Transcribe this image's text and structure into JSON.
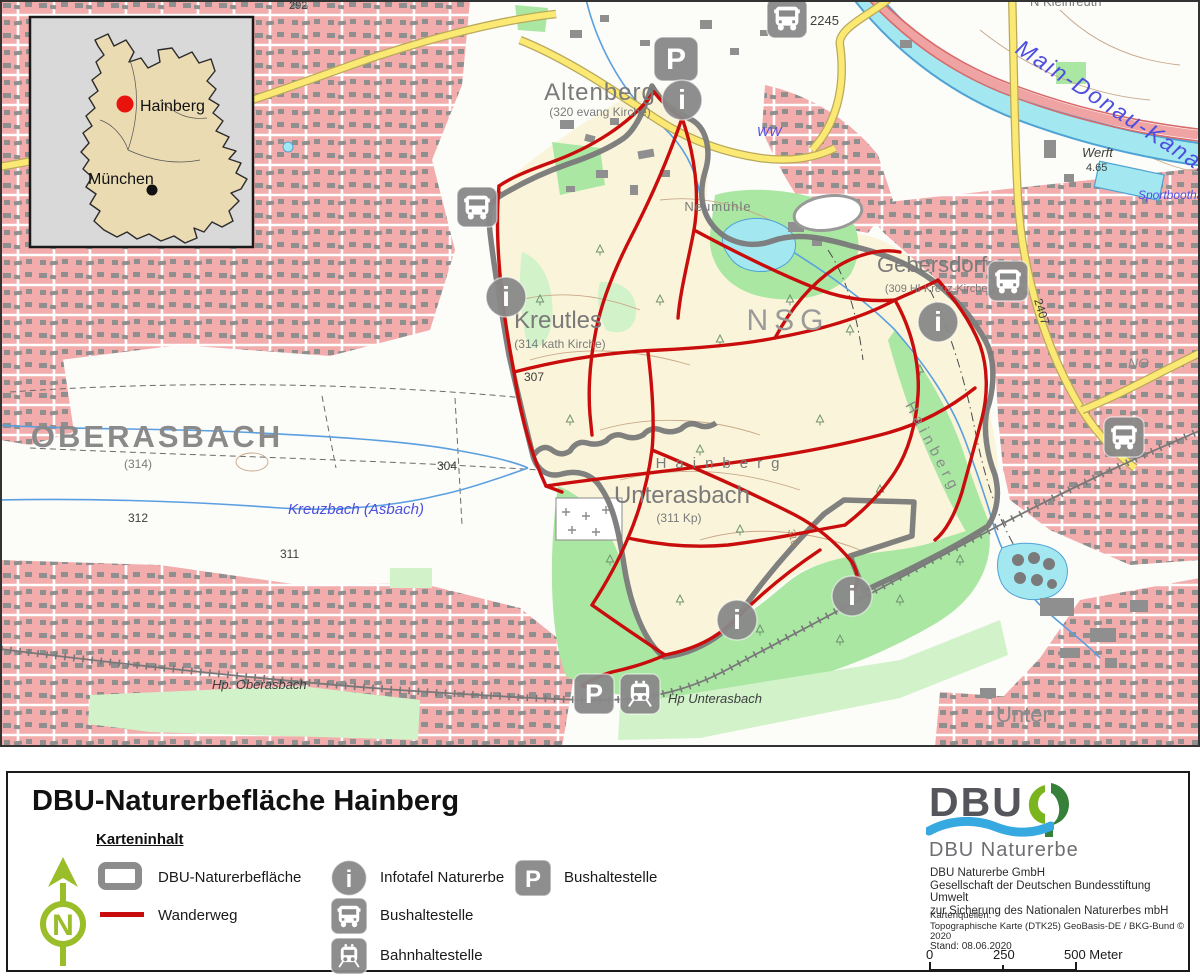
{
  "colors": {
    "trail_red": "#C90D0D",
    "boundary_gray": "#7B7B7B",
    "icon_gray": "#898989",
    "urban_pink": "#F2ACAC",
    "nature_cream": "#FAF5DA",
    "forest_green": "#A9E7A2",
    "forest_light": "#D2F2CA",
    "water_cyan": "#A3E8F0",
    "road_yellow": "#FBE974",
    "north_arrow_green": "#9ABD2A",
    "logo_green_light": "#7AB51D",
    "logo_green_dark": "#37803A",
    "logo_wave_blue": "#36A9E1",
    "marker_red": "#E8130C",
    "inset_land": "#EADBB2",
    "inset_bg": "#D9D9D9"
  },
  "inset": {
    "labels": {
      "hainberg": "Hainberg",
      "muenchen": "München"
    }
  },
  "map": {
    "icon_glyphs": {
      "info": "i",
      "parking": "P"
    },
    "labels": {
      "region_292": "292",
      "altenberg": "Altenberg",
      "altenberg_sub": "(320 evang Kirche)",
      "neumuehle": "Neumühle",
      "kleinreuth": "N Kleinreuth",
      "kreutles": "Kreutles",
      "kreutles_sub": "(314 kath Kirche)",
      "nsg": "NSG",
      "oberasbach": "OBERASBACH",
      "oberasbach_sub": "(314)",
      "gebersdorf": "Gebersdorf",
      "gebersdorf_sub": "(309 Hl-Kreuz-Kirche)",
      "hainberg_flur": "Hainberg",
      "hainberg_hill": "Hainberg",
      "unterasbach": "Unterasbach",
      "unterasbach_sub": "(311 Kp)",
      "unter": "Unter",
      "main_donau_kanal": "Main-Donau-Kanal",
      "kreuzbach": "Kreuzbach  (Asbach)",
      "werft": "Werft",
      "werft_elev": "4.65",
      "sportboothafen": "Sportboothafen",
      "ww": "WW",
      "hp_oberasbach": "Hp. Oberasbach",
      "hp_unterasbach": "Hp Unterasbach",
      "elev_304": "304",
      "elev_307": "307",
      "elev_310": "310",
      "elev_311": "311",
      "elev_312": "312",
      "road_2245": "2245",
      "road_2407": "2407",
      "no_frag": "NO"
    }
  },
  "legend": {
    "title": "DBU-Naturerbefläche Hainberg",
    "section_title": "Karteninhalt",
    "north_letter": "N",
    "items": [
      {
        "label": "DBU-Naturerbefläche"
      },
      {
        "label": "Wanderweg"
      },
      {
        "label": "Infotafel Naturerbe"
      },
      {
        "label": "Bushaltestelle"
      },
      {
        "label": "Bahnhaltestelle"
      },
      {
        "label": "Bushaltestelle"
      }
    ],
    "logo": {
      "wordmark": "DBU",
      "brand": "DBU Naturerbe"
    },
    "org_lines": [
      "DBU Naturerbe GmbH",
      "Gesellschaft der Deutschen Bundesstiftung Umwelt",
      "zur Sicherung des Nationalen Naturerbes mbH"
    ],
    "sources_label": "Kartenquellen:",
    "sources": "Topographische Karte (DTK25) GeoBasis-DE / BKG-Bund © 2020",
    "stand": "Stand: 08.06.2020",
    "scale": {
      "start": "0",
      "mid": "250",
      "end": "500 Meter"
    }
  }
}
